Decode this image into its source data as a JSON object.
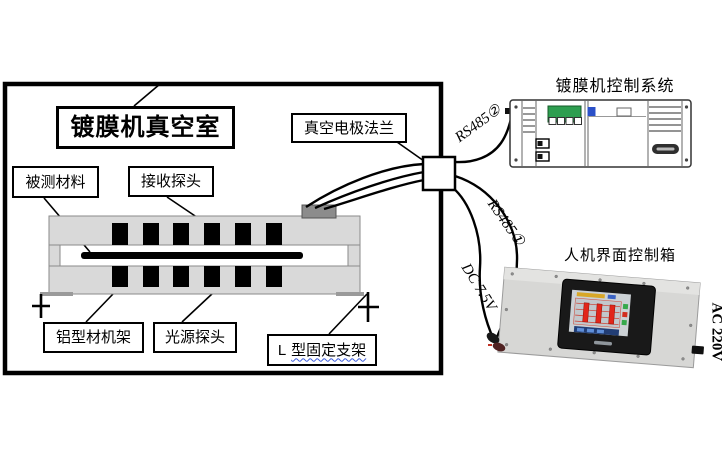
{
  "chamber": {
    "title": "镀膜机真空室",
    "material_label": "被测材料",
    "receiver_label": "接收探头",
    "frame_label": "铝型材机架",
    "light_label": "光源探头",
    "bracket_prefix": "L",
    "bracket_main": "型固定支架",
    "flange_label": "真空电极法兰"
  },
  "controller": {
    "title": "镀膜机控制系统"
  },
  "hmi": {
    "title": "人机界面控制箱"
  },
  "links": {
    "rs485_top": "RS485②",
    "rs485_bottom": "RS485①",
    "dc_power": "DC 7.5V",
    "ac_power": "AC 220V"
  },
  "colors": {
    "rail_gray": "#d9d9d9",
    "connector_gray": "#8c8c8c",
    "plc_display_green": "#2e9e50",
    "plc_led_blue": "#2b50c8",
    "hmi_plate_gray": "#d7d7d5",
    "hmi_bezel_black": "#191919",
    "screen_bar_red": "#e2261a",
    "indicator_green": "#36a94c",
    "underline_blue": "#3b5bdb"
  }
}
